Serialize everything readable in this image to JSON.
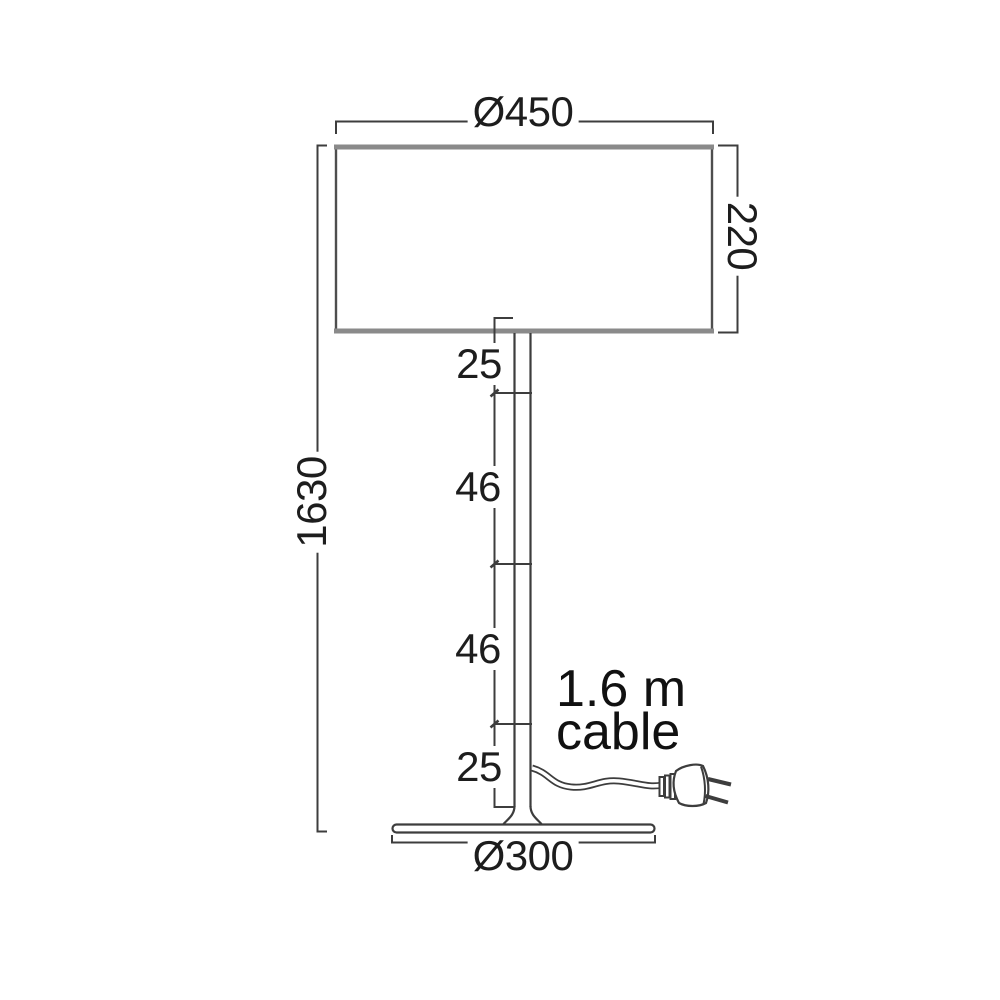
{
  "diagram": {
    "kind": "lamp-dimension-drawing",
    "labels": {
      "shade_diameter": "Ø450",
      "shade_height": "220",
      "total_height": "1630",
      "pole_segment_1": "25",
      "pole_segment_2": "46",
      "pole_segment_3": "46",
      "pole_segment_4": "25",
      "base_diameter": "Ø300",
      "cable_note_line1": "1.6 m",
      "cable_note_line2": "cable"
    },
    "icons": {
      "plug": "two-prong-plug-icon"
    },
    "colors": {
      "line": "#3d3d3d",
      "shade_edge": "#8a8a8a",
      "text": "#1d1d1d",
      "background": "#ffffff"
    }
  }
}
